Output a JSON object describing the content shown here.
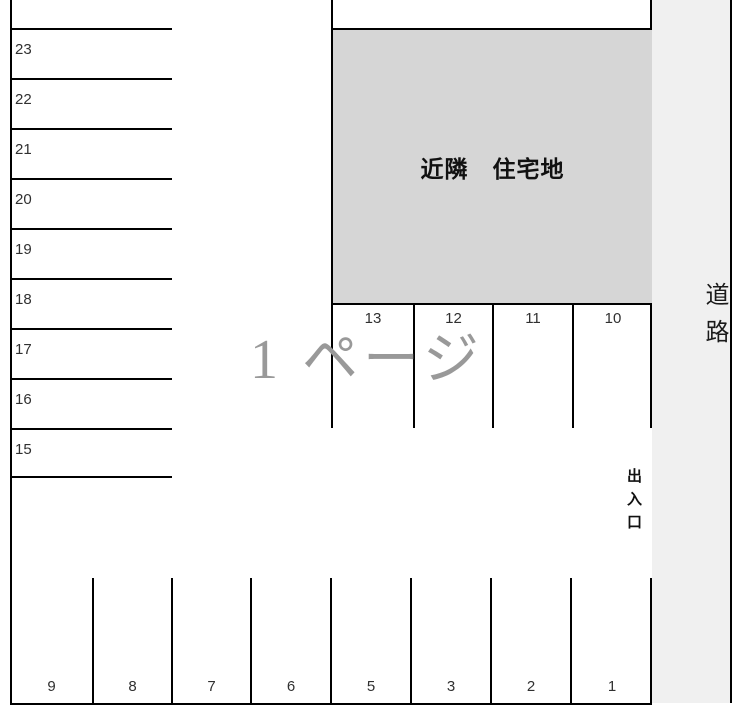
{
  "diagram": {
    "kind": "parking-lot-layout",
    "neighborhood_label": "近隣　住宅地",
    "road_label": "道路",
    "entrance_label": "出入口",
    "watermark": "1 ページ",
    "left_column_spaces": [
      "23",
      "22",
      "21",
      "20",
      "19",
      "18",
      "17",
      "16",
      "15"
    ],
    "middle_row_spaces": [
      "13",
      "12",
      "11",
      "10"
    ],
    "bottom_row_spaces": [
      "9",
      "8",
      "7",
      "6",
      "5",
      "3",
      "2",
      "1"
    ],
    "colors": {
      "block_fill": "#d6d6d6",
      "road_fill": "#f0f0f0",
      "line": "#000000",
      "watermark_gray": "#999999",
      "text": "#303030"
    }
  }
}
